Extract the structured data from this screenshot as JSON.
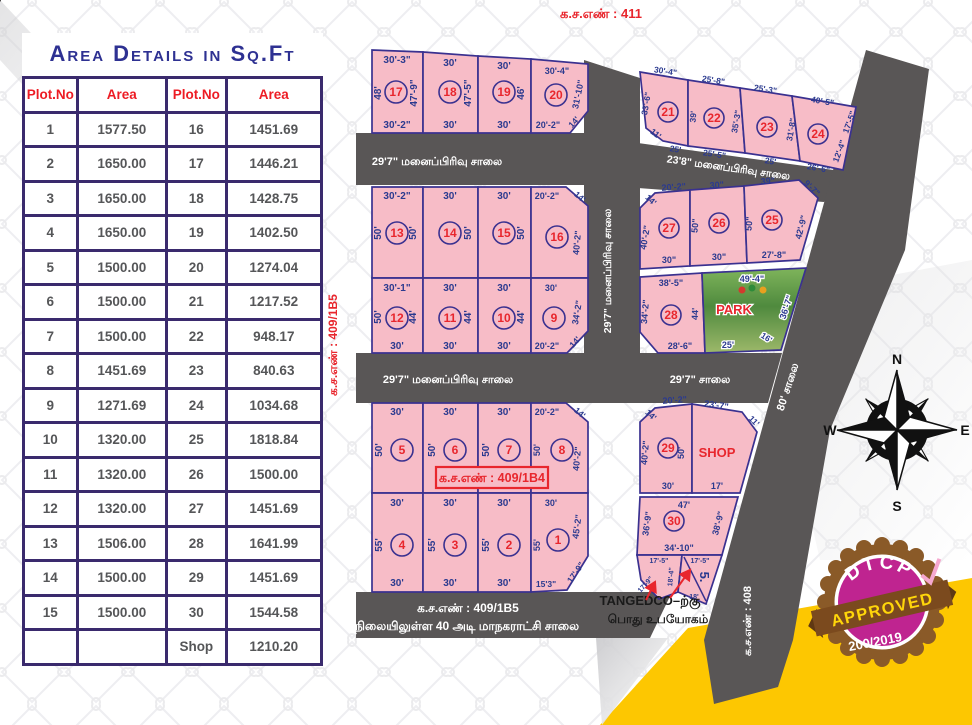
{
  "colors": {
    "plot_pink": "#f7bcc7",
    "road_gray": "#595656",
    "dim_blue": "#2b3a8f",
    "red": "#e8262d",
    "table_purple": "#3a2a6d",
    "yellow": "#fdc701",
    "seal_magenta": "#bf2490",
    "seal_brown": "#8a5a28"
  },
  "table": {
    "title": "Area Details in Sq.Ft",
    "headers": [
      "Plot.No",
      "Area",
      "Plot.No",
      "Area"
    ],
    "rows": [
      [
        "1",
        "1577.50",
        "16",
        "1451.69"
      ],
      [
        "2",
        "1650.00",
        "17",
        "1446.21"
      ],
      [
        "3",
        "1650.00",
        "18",
        "1428.75"
      ],
      [
        "4",
        "1650.00",
        "19",
        "1402.50"
      ],
      [
        "5",
        "1500.00",
        "20",
        "1274.04"
      ],
      [
        "6",
        "1500.00",
        "21",
        "1217.52"
      ],
      [
        "7",
        "1500.00",
        "22",
        "948.17"
      ],
      [
        "8",
        "1451.69",
        "23",
        "840.63"
      ],
      [
        "9",
        "1271.69",
        "24",
        "1034.68"
      ],
      [
        "10",
        "1320.00",
        "25",
        "1818.84"
      ],
      [
        "11",
        "1320.00",
        "26",
        "1500.00"
      ],
      [
        "12",
        "1320.00",
        "27",
        "1451.69"
      ],
      [
        "13",
        "1506.00",
        "28",
        "1641.99"
      ],
      [
        "14",
        "1500.00",
        "29",
        "1451.69"
      ],
      [
        "15",
        "1500.00",
        "30",
        "1544.58"
      ],
      [
        "",
        "",
        "Shop",
        "1210.20"
      ]
    ]
  },
  "map": {
    "surveys": {
      "top": "க.ச.எண் : 411",
      "left": "க.ச.எண் : 409/1B5",
      "box": "க.ச.எண் : 409/1B4",
      "right": "க.ச.எண் : 408",
      "plot5_label": "5."
    },
    "roads": {
      "row1": "29'7\" மனைப்பிரிவு சாலை",
      "right_top": "23'8\" மனைப்பிரிவு சாலை",
      "center_vertical": "29'7\" மனைப்பிரிவு சாலை",
      "row3": "29'7\" மனைப்பிரிவு சாலை",
      "middle_right": "29'7\" சாலை",
      "road80": "80' சாலை",
      "bottom_line1": "க.ச.எண் : 409/1B5",
      "bottom_line2": "நிலையிலுள்ள 40 அடி மாநகராட்சி சாலை"
    },
    "tangedco": {
      "line1": "TANGEDCO–ற்கு",
      "line2": "பொது உபயோகம்"
    },
    "compass": {
      "n": "N",
      "e": "E",
      "s": "S",
      "w": "W"
    },
    "seal": {
      "line1": "DTCP",
      "line2": "APPROVED",
      "line3": "200/2019"
    },
    "plots": {
      "p17": {
        "no": "17",
        "top": "30'-3\"",
        "left": "48'",
        "right": "47'-9\"",
        "bottom": "30'-2\""
      },
      "p18": {
        "no": "18",
        "top": "30'",
        "right": "47'-5\"",
        "bottom": "30'"
      },
      "p19": {
        "no": "19",
        "top": "30'",
        "right": "46'",
        "bottom": "30'"
      },
      "p20": {
        "no": "20",
        "top": "30'-4\"",
        "right": "31'-10\"",
        "diag": "14'",
        "bottom": "20'-2\""
      },
      "p21": {
        "no": "21",
        "top": "30'-4\"",
        "left": "33'-6\"",
        "diag": "11'",
        "bottom": "25'"
      },
      "p22": {
        "no": "22",
        "top": "25'-8\"",
        "left": "39'",
        "right": "35'-3\"",
        "bottom": "25'-5\""
      },
      "p23": {
        "no": "23",
        "top": "25'-3\"",
        "right": "31'-8\"",
        "bottom": "25'"
      },
      "p24": {
        "no": "24",
        "top": "40'-5\"",
        "right_upper": "17'-5\"",
        "right_lower": "12'-4\"",
        "bottom": "26'-6\""
      },
      "p13": {
        "no": "13",
        "top": "30'-2\"",
        "left": "50'",
        "right": "50'"
      },
      "p14": {
        "no": "14",
        "top": "30'",
        "right": "50'"
      },
      "p15": {
        "no": "15",
        "top": "30'",
        "right": "50'"
      },
      "p16": {
        "no": "16",
        "top": "20'-2\"",
        "diag": "14'",
        "right": "40'-2\""
      },
      "p12": {
        "no": "12",
        "top": "30'-1\"",
        "left": "50'",
        "right": "44'",
        "bottom": "30'"
      },
      "p11": {
        "no": "11",
        "top": "30'",
        "right": "44'",
        "bottom": "30'"
      },
      "p10": {
        "no": "10",
        "top": "30'",
        "right": "44'",
        "bottom": "30'"
      },
      "p9": {
        "no": "9",
        "top": "30'",
        "right": "34'-2\"",
        "diag": "14'",
        "bottom": "20'-2\""
      },
      "p27": {
        "no": "27",
        "diag": "14'",
        "top": "20'-2\"",
        "left": "40'-2\"",
        "bottom": "30\""
      },
      "p26": {
        "no": "26",
        "top": "30\"",
        "left": "50\"",
        "bottom": "30\""
      },
      "p25": {
        "no": "25",
        "top": "39\"",
        "diag": "9'-7\"",
        "left": "50\"",
        "right": "42'-9\"",
        "bottom": "27'-8\""
      },
      "p28": {
        "no": "28",
        "top": "38'-5\"",
        "left": "34'-2\"",
        "right": "44'",
        "bottom": "28'-6\""
      },
      "park": {
        "label": "PARK",
        "top": "49'-4\"",
        "right": "36'-7\"",
        "bottom": "25'",
        "diag": "16'"
      },
      "p5": {
        "no": "5",
        "top": "30'",
        "left": "50'"
      },
      "p6": {
        "no": "6",
        "top": "30'",
        "left": "50'"
      },
      "p7": {
        "no": "7",
        "top": "30'",
        "left": "50'"
      },
      "p8": {
        "no": "8",
        "top": "20'-2\"",
        "diag": "14'",
        "left": "50'",
        "right": "40'-2\""
      },
      "p4": {
        "no": "4",
        "top": "30'",
        "left": "55'",
        "bottom": "30'"
      },
      "p3": {
        "no": "3",
        "top": "30'",
        "left": "55'",
        "bottom": "30'"
      },
      "p2": {
        "no": "2",
        "top": "30'",
        "left": "55'",
        "bottom": "30'"
      },
      "p1": {
        "no": "1",
        "top": "30'",
        "left": "55'",
        "right": "45'-2\"",
        "diag": "17'-9\"",
        "bottom": "15'3\""
      },
      "p29": {
        "no": "29",
        "diag": "14'",
        "top": "20'-2\"",
        "left": "40'-2\"",
        "right": "50'",
        "bottom": "30'"
      },
      "shop": {
        "label": "SHOP",
        "top": "23'-7\"",
        "diag": "11'",
        "bottom": "17'"
      },
      "p30": {
        "no": "30",
        "top": "47'",
        "left": "36'-9\"",
        "right": "38'-9\"",
        "bottom": "34'-10\""
      },
      "t_left": {
        "top": "17'-5\"",
        "diag": "17'-9\"",
        "right": "18'-4\""
      },
      "t_right": {
        "top": "17'-5\"",
        "bottom": "18'"
      }
    }
  }
}
